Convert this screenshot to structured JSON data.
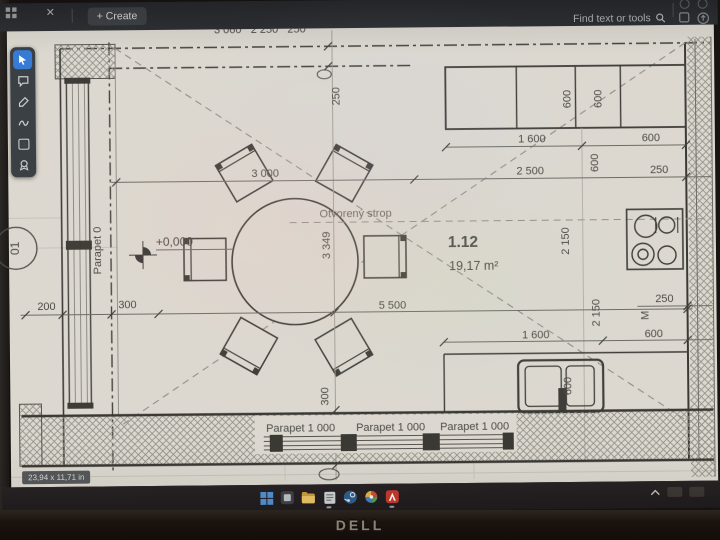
{
  "titlebar": {
    "tab_close": "✕",
    "create_button": "+ Create",
    "find_placeholder": "Find text or tools"
  },
  "quick_tools": [
    "select-tool",
    "comment-tool",
    "highlight-tool",
    "draw-tool",
    "add-text-tool",
    "stamp-tool"
  ],
  "statusbar": {
    "page_size": "23,94 x 11,71 in"
  },
  "plan": {
    "room_number": "1.12",
    "room_area": "19,17 m²",
    "ceiling_label": "Otvorený strop",
    "level_label": "+0,000",
    "grid_bubble": "01",
    "parapet_left": "Parapet 0",
    "parapet_1": "Parapet 1 000",
    "parapet_2": "Parapet 1 000",
    "parapet_3": "Parapet 1 000",
    "top_clipped_dims": "3 060   2 250   250",
    "dims": {
      "d200": "200",
      "d300": "300",
      "d3000": "3 000",
      "d250_top": "250",
      "d3349": "3 349",
      "d5500": "5 500",
      "d1600_top": "1 600",
      "d600_top": "600",
      "d2500": "2 500",
      "d250_right": "250",
      "cab600a": "600",
      "cab600b": "600",
      "mid600": "600",
      "w2150a": "2 150",
      "w2150b": "2 150",
      "cook250": "250",
      "m_label": "M",
      "low600": "600",
      "low1600": "1 600",
      "sink600": "600",
      "bottom300": "300"
    }
  },
  "taskbar": {
    "icons": [
      "start",
      "widgets",
      "file-explorer",
      "notepad",
      "steam",
      "photos",
      "acrobat"
    ]
  },
  "monitor": {
    "brand": "DELL"
  },
  "colors": {
    "accent_blue": "#2e7ce0",
    "paper": "#d8d6d0",
    "ink": "#3f3d3a",
    "topbar": "#2b2e33"
  }
}
